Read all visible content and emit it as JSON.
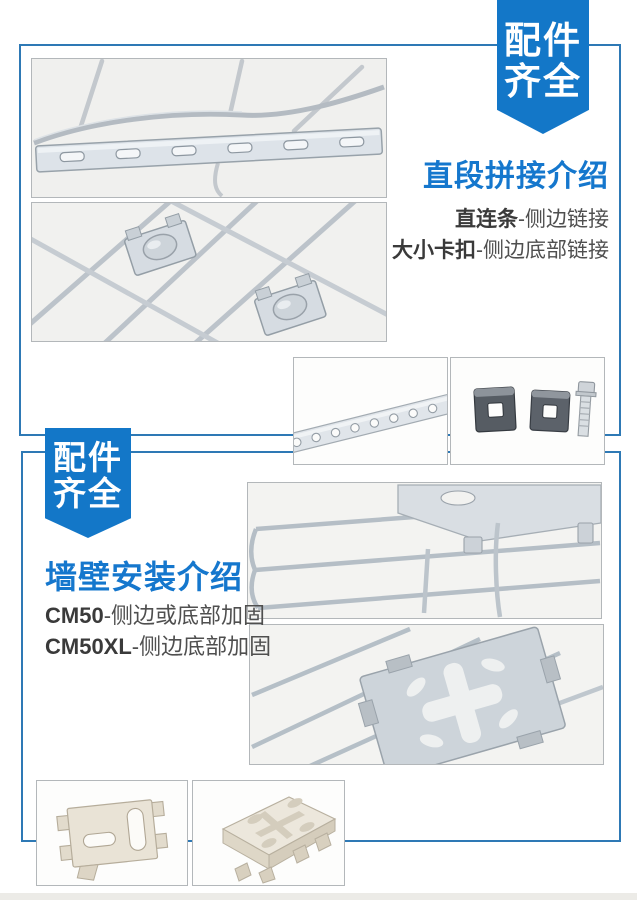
{
  "colors": {
    "badge-blue": "#1377c8",
    "title-blue": "#1577cd",
    "frame-blue": "#2e79b5",
    "term-color": "#3a3a3a",
    "desc-color": "#4f4f4f",
    "bottom-strip": "#ecebe7"
  },
  "badge_top": {
    "line1": "配件",
    "line2": "齐全"
  },
  "badge_left": {
    "line1": "配件",
    "line2": "齐全"
  },
  "section1": {
    "title": "直段拼接介绍",
    "features": [
      {
        "term": "直连条",
        "desc": "-侧边链接"
      },
      {
        "term": "大小卡扣",
        "desc": "-侧边底部链接"
      }
    ]
  },
  "section2": {
    "title": "墙壁安装介绍",
    "features": [
      {
        "term": "CM50",
        "desc": "-侧边或底部加固"
      },
      {
        "term": "CM50XL",
        "desc": "-侧边底部加固"
      }
    ]
  }
}
